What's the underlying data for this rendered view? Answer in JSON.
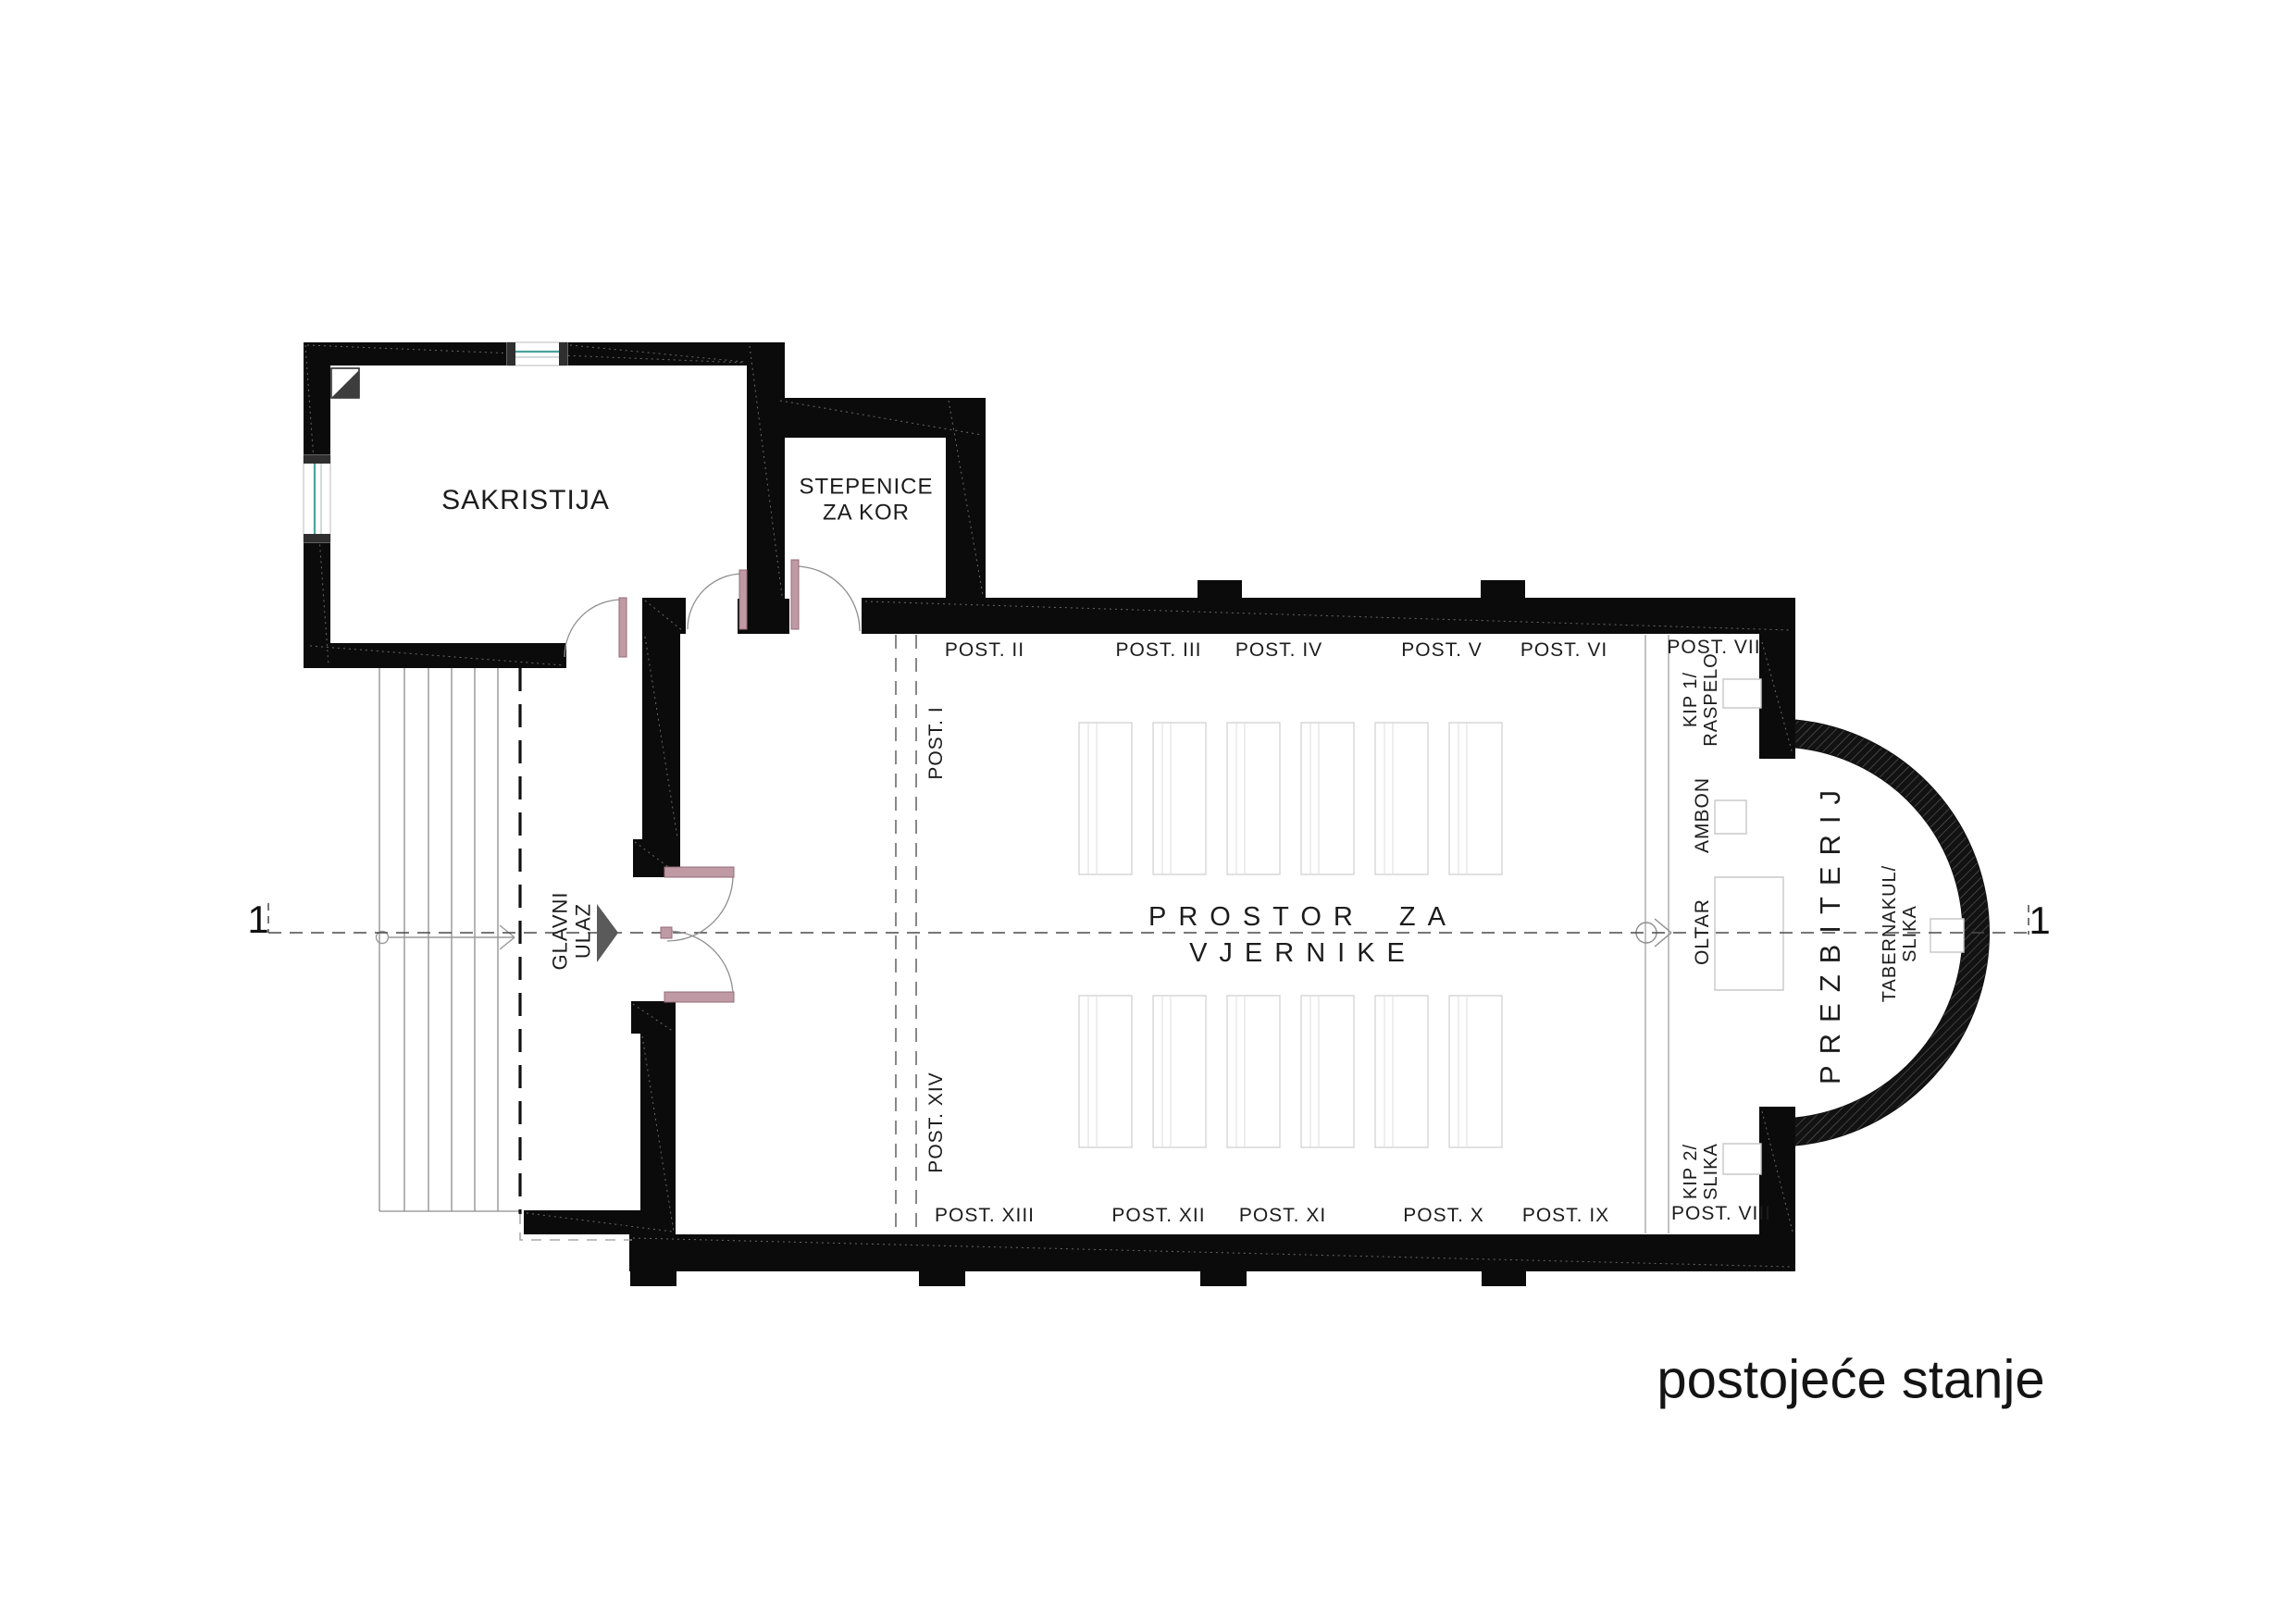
{
  "drawing": {
    "title": "postojeće stanje",
    "type_note": "church floor plan",
    "section_markers": {
      "left": "1",
      "right": "1"
    }
  },
  "rooms": {
    "sakristija": "SAKRISTIJA",
    "stepenice_line1": "STEPENICE",
    "stepenice_line2": "ZA KOR",
    "nave_line1": "PROSTOR ZA",
    "nave_line2": "VJERNIKE",
    "prezbiterij": "PREZBITERIJ"
  },
  "entrance": {
    "line1": "GLAVNI",
    "line2": "ULAZ"
  },
  "furniture": {
    "oltar": "OLTAR",
    "ambon": "AMBON",
    "tabernakul_line1": "TABERNAKUL/",
    "tabernakul_line2": "SLIKA",
    "kip1_line1": "KIP 1/",
    "kip1_line2": "RASPELO",
    "kip2_line1": "KIP 2/",
    "kip2_line2": "SLIKA"
  },
  "stations": {
    "top": [
      "POST. II",
      "POST. III",
      "POST. IV",
      "POST. V",
      "POST. VI",
      "POST. VII"
    ],
    "bottom": [
      "POST. XIII",
      "POST. XII",
      "POST. XI",
      "POST. X",
      "POST. IX",
      "POST. VIII"
    ],
    "left_upper": "POST. I",
    "left_lower": "POST. XIV"
  },
  "colors": {
    "wall": "#0b0b0b",
    "window_glass": "#4aa39b",
    "door_leaf": "#bf9aa5",
    "centerline": "#4a4a4a",
    "furniture_outline": "#c8c8c8"
  }
}
